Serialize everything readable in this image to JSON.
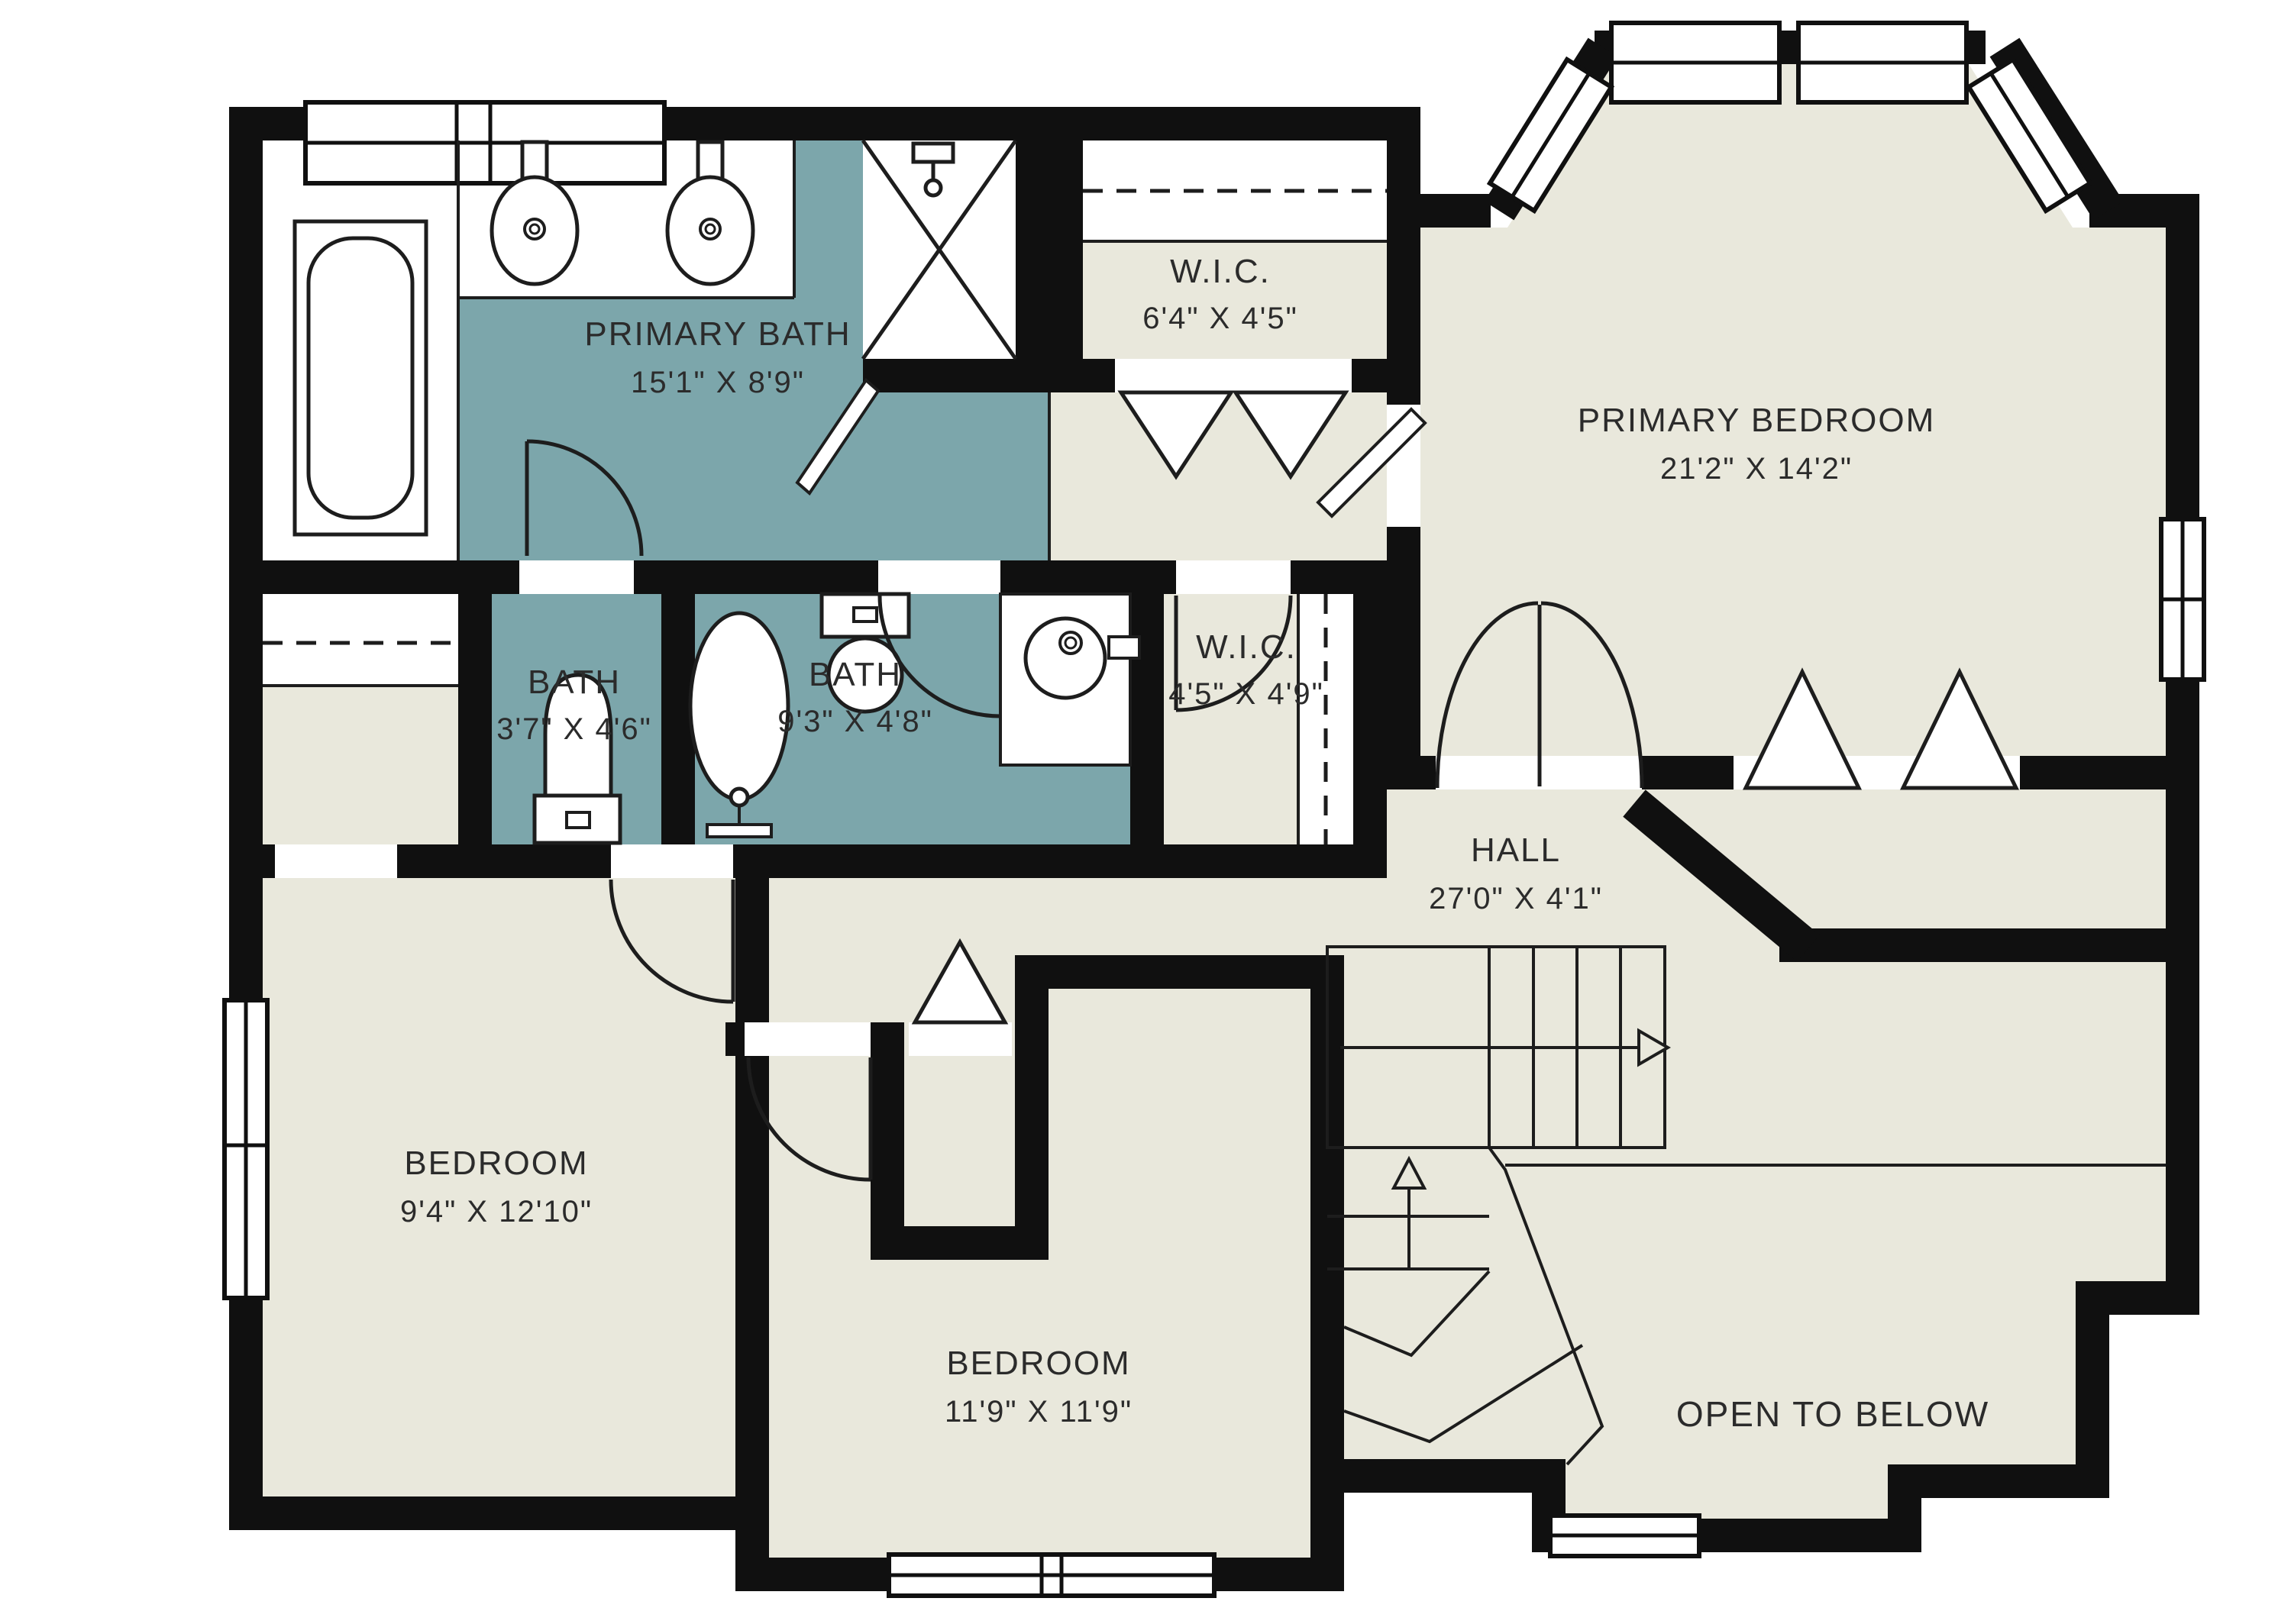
{
  "plan": {
    "type": "floor-plan",
    "floor": "second-floor",
    "colors": {
      "wall": "#101010",
      "bathroom_fill": "#7ca6ab",
      "floor_fill": "#e9e8dc",
      "fixture_line": "#1d1d1d",
      "text": "#2b2b2b",
      "white": "#ffffff"
    },
    "rooms": [
      {
        "id": "primary-bath",
        "name": "PRIMARY BATH",
        "dims": "15'1\" X 8'9\""
      },
      {
        "id": "wic-1",
        "name": "W.I.C.",
        "dims": "6'4\" X 4'5\""
      },
      {
        "id": "primary-bedroom",
        "name": "PRIMARY BEDROOM",
        "dims": "21'2\" X 14'2\""
      },
      {
        "id": "bath-small",
        "name": "BATH",
        "dims": "3'7\" X 4'6\""
      },
      {
        "id": "bath-2",
        "name": "BATH",
        "dims": "9'3\" X 4'8\""
      },
      {
        "id": "wic-2",
        "name": "W.I.C.",
        "dims": "4'5\" X 4'9\""
      },
      {
        "id": "hall",
        "name": "HALL",
        "dims": "27'0\" X 4'1\""
      },
      {
        "id": "bedroom-left",
        "name": "BEDROOM",
        "dims": "9'4\" X 12'10\""
      },
      {
        "id": "bedroom-center",
        "name": "BEDROOM",
        "dims": "11'9\" X 11'9\""
      },
      {
        "id": "open-to-below",
        "name": "OPEN TO BELOW",
        "dims": ""
      }
    ],
    "fixtures": [
      "bathtub-built-in",
      "double-vanity-sinks",
      "shower-stall",
      "toilet",
      "freestanding-tub",
      "toilet-2",
      "round-sink",
      "closet-rods",
      "bifold-doors",
      "french-doors",
      "staircase",
      "windows"
    ]
  }
}
